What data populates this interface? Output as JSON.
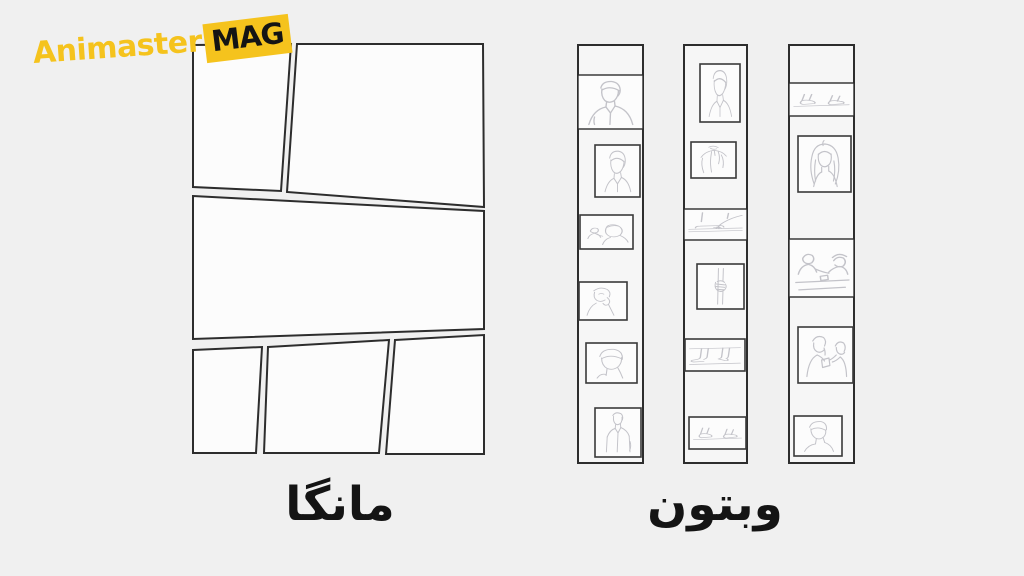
{
  "logo": {
    "name": "Animaster",
    "badge": "MAG"
  },
  "labels": {
    "manga": "مانگا",
    "webtoon": "وبتون"
  },
  "palette": {
    "background": "#f0f0f0",
    "panel_fill": "#fcfcfc",
    "panel_border": "#2d2d2d",
    "strip_fill": "#f6f6f6",
    "sketch_line": "#c3c3c9",
    "accent": "#f5c31d",
    "badge_text": "#141414",
    "label_color": "#141414"
  },
  "manga_page": {
    "panel_count": 6,
    "rows": [
      {
        "panels": 2
      },
      {
        "panels": 1
      },
      {
        "panels": 3
      }
    ],
    "panel_style": "empty slanted panels"
  },
  "webtoon": {
    "strip_count": 3,
    "strips": [
      {
        "name": "strip-1",
        "panels": [
          "blank",
          "man-bust",
          "man-portrait",
          "two-people-scene",
          "person-leaning",
          "person-closeup",
          "man-standing"
        ]
      },
      {
        "name": "strip-2",
        "panels": [
          "man-portrait",
          "shoulder-torso",
          "hand-on-table",
          "hand-gripping",
          "legs-seated",
          "feet-shoes"
        ]
      },
      {
        "name": "strip-3",
        "panels": [
          "blank",
          "walking-feet",
          "woman-portrait",
          "couple-at-table",
          "couple-talking",
          "man-closeup"
        ]
      }
    ]
  }
}
